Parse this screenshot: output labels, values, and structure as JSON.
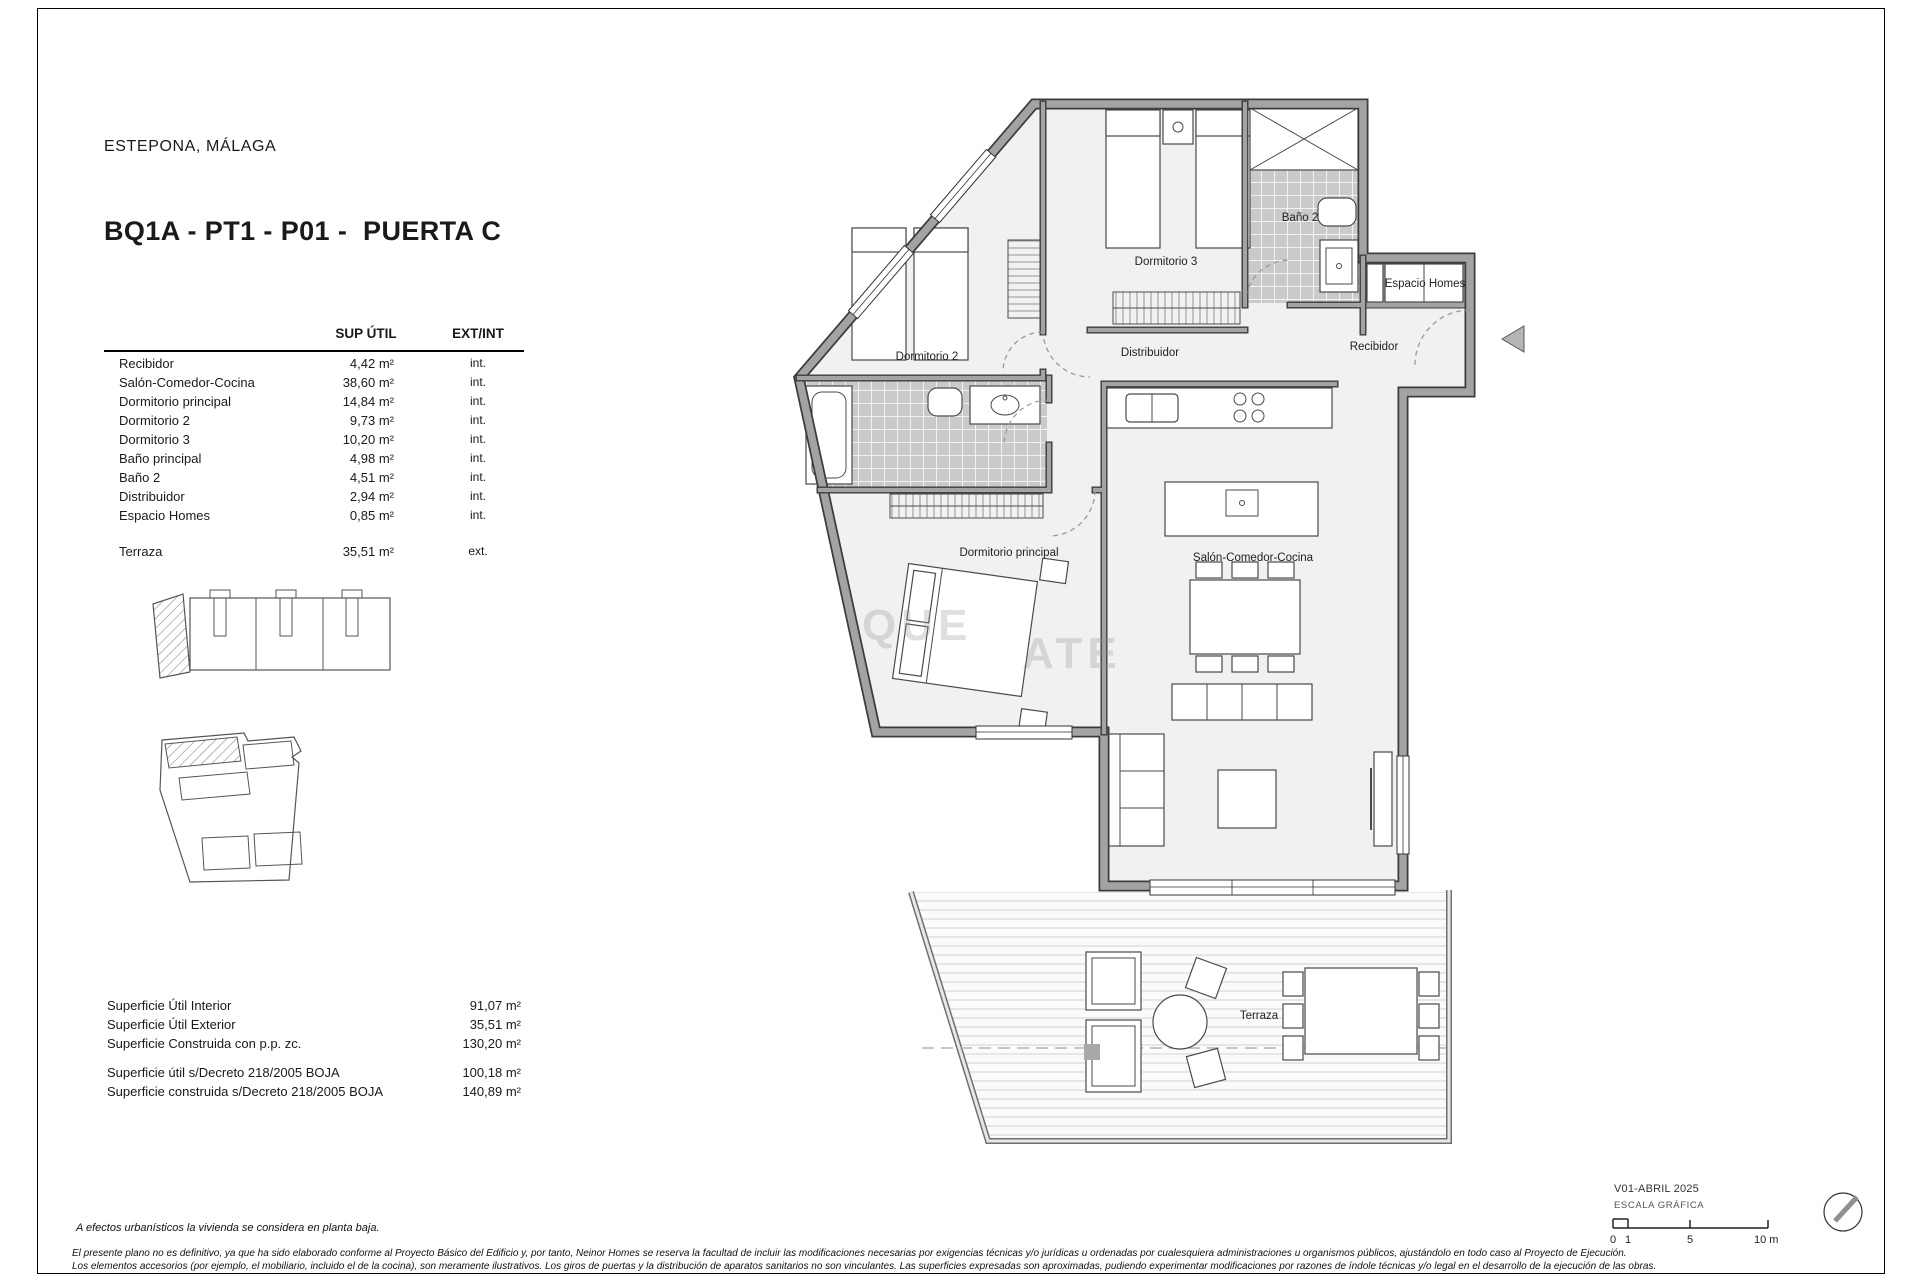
{
  "header": {
    "location": "ESTEPONA, MÁLAGA",
    "title": "BQ1A - PT1 - P01 -  PUERTA C"
  },
  "areas_table": {
    "header_area": "SUP ÚTIL",
    "header_type": "EXT/INT",
    "rows": [
      {
        "label": "Recibidor",
        "area": "4,42 m²",
        "type": "int."
      },
      {
        "label": "Salón-Comedor-Cocina",
        "area": "38,60 m²",
        "type": "int."
      },
      {
        "label": "Dormitorio principal",
        "area": "14,84 m²",
        "type": "int."
      },
      {
        "label": "Dormitorio 2",
        "area": "9,73 m²",
        "type": "int."
      },
      {
        "label": "Dormitorio 3",
        "area": "10,20 m²",
        "type": "int."
      },
      {
        "label": "Baño principal",
        "area": "4,98 m²",
        "type": "int."
      },
      {
        "label": "Baño 2",
        "area": "4,51 m²",
        "type": "int."
      },
      {
        "label": "Distribuidor",
        "area": "2,94 m²",
        "type": "int."
      },
      {
        "label": "Espacio Homes",
        "area": "0,85 m²",
        "type": "int."
      }
    ],
    "terrace_row": {
      "label": "Terraza",
      "area": "35,51 m²",
      "type": "ext."
    }
  },
  "summary": {
    "rows": [
      {
        "label": "Superficie Útil Interior",
        "value": "91,07 m²"
      },
      {
        "label": "Superficie Útil Exterior",
        "value": "35,51 m²"
      },
      {
        "label": "Superficie Construida con p.p. zc.",
        "value": "130,20 m²"
      }
    ],
    "decree_rows": [
      {
        "label": "Superficie útil s/Decreto 218/2005 BOJA",
        "value": "100,18 m²"
      },
      {
        "label": "Superficie construida s/Decreto 218/2005 BOJA",
        "value": "140,89 m²"
      }
    ]
  },
  "floorplan": {
    "labels": {
      "dormitorio_2": "Dormitorio 2",
      "dormitorio_3": "Dormitorio 3",
      "bano_2": "Baño 2",
      "espacio_homes": "Espacio Homes",
      "distribuidor": "Distribuidor",
      "recibidor": "Recibidor",
      "dormitorio_principal": "Dormitorio principal",
      "salon": "Salón-Comedor-Cocina",
      "terraza": "Terraza"
    },
    "watermark": {
      "fragment_1": "QUE",
      "fragment_2": "ATE"
    }
  },
  "footnote": "A efectos urbanísticos la vivienda se considera en planta baja.",
  "disclaimer": {
    "line_1": "El presente plano no es definitivo, ya que ha sido elaborado conforme al Proyecto Básico del Edificio y, por tanto, Neinor Homes se reserva la facultad de incluir las modificaciones necesarias por exigencias técnicas y/o jurídicas u ordenadas por cualesquiera administraciones u organismos públicos, ajustándolo en todo caso al Proyecto de Ejecución.",
    "line_2": "Los elementos accesorios (por ejemplo, el mobiliario, incluido el de la cocina), son meramente ilustrativos. Los giros de puertas y la distribución de aparatos sanitarios no son vinculantes. Las superficies expresadas son aproximadas, pudiendo experimentar modificaciones por razones de índole técnicas y/o legal en el desarrollo de la ejecución de las obras."
  },
  "titleblock": {
    "version": "V01-ABRIL 2025",
    "scale_label": "ESCALA GRÁFICA",
    "scale_ticks": {
      "t0": "0",
      "t1": "1",
      "t5": "5",
      "t10": "10 m"
    }
  },
  "colors": {
    "wall_gray": "#a3a3a3",
    "wall_edge": "#3c3c3c",
    "tile_gray": "#cacaca",
    "floor": "#f1f1f1",
    "deck_line": "#d8d8d8"
  }
}
